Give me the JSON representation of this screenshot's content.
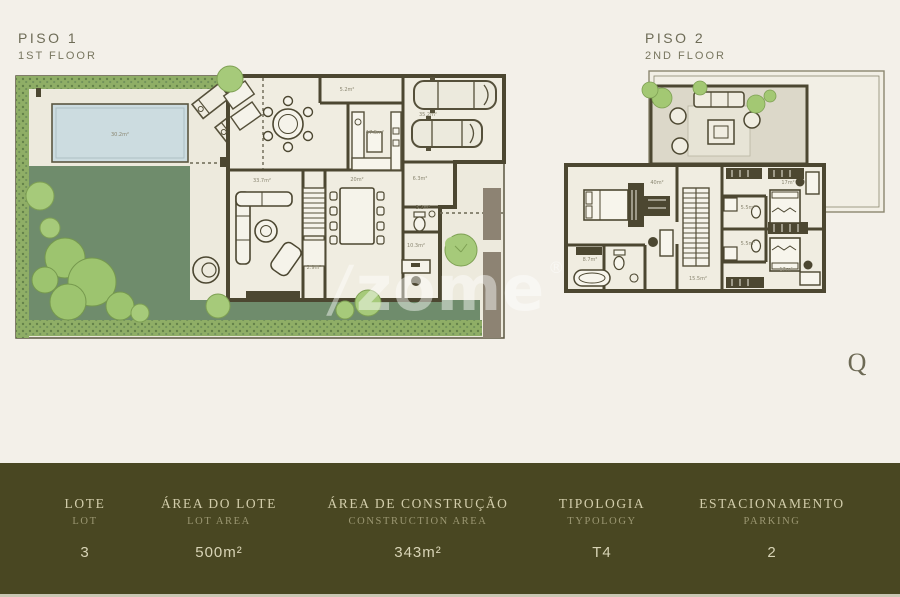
{
  "colors": {
    "page_background": "#f3f0e9",
    "plan_floor": "#f0ede1",
    "wall": "#4c4731",
    "lawn": "#6f8c6c",
    "hedge": "#8fae66",
    "bush": "#9dc46f",
    "pool_water": "#ccdce0",
    "terrace": "#dcd8c9",
    "gate_wall": "#8d8373",
    "bar_background": "#494722",
    "bar_label": "#d2cdab",
    "bar_sublabel": "#9b9772",
    "bar_value": "#d8d4b6"
  },
  "floor1": {
    "title_pt": "PISO 1",
    "title_en": "1ST FLOOR",
    "areas": {
      "pool": "30.2m²",
      "garage": "35.2m²",
      "entry": "5.2m²",
      "kitchen": "17.5m²",
      "dining": "20m²",
      "living": "33.7m²",
      "hall": "6.3m²",
      "wc": "3.2m²",
      "office": "10.3m²",
      "stairs": "2.9m²"
    }
  },
  "floor2": {
    "title_pt": "PISO 2",
    "title_en": "2ND FLOOR",
    "areas": {
      "suite": "40m²",
      "suite_bath": "8.7m²",
      "landing": "15.5m²",
      "bath_1": "5.5m²",
      "bath_2": "5.5m²",
      "bedroom_1": "17m²",
      "bedroom_2": "17m²"
    }
  },
  "watermark": {
    "slash": "/",
    "text": "zome",
    "registered": "®"
  },
  "compass": {
    "glyph": "Q"
  },
  "summary_bar": {
    "columns": [
      {
        "label_pt": "LOTE",
        "label_en": "LOT",
        "value": "3"
      },
      {
        "label_pt": "ÁREA DO LOTE",
        "label_en": "LOT AREA",
        "value": "500m²"
      },
      {
        "label_pt": "ÁREA DE CONSTRUÇÃO",
        "label_en": "CONSTRUCTION AREA",
        "value": "343m²"
      },
      {
        "label_pt": "TIPOLOGIA",
        "label_en": "TYPOLOGY",
        "value": "T4"
      },
      {
        "label_pt": "ESTACIONAMENTO",
        "label_en": "PARKING",
        "value": "2"
      }
    ]
  }
}
